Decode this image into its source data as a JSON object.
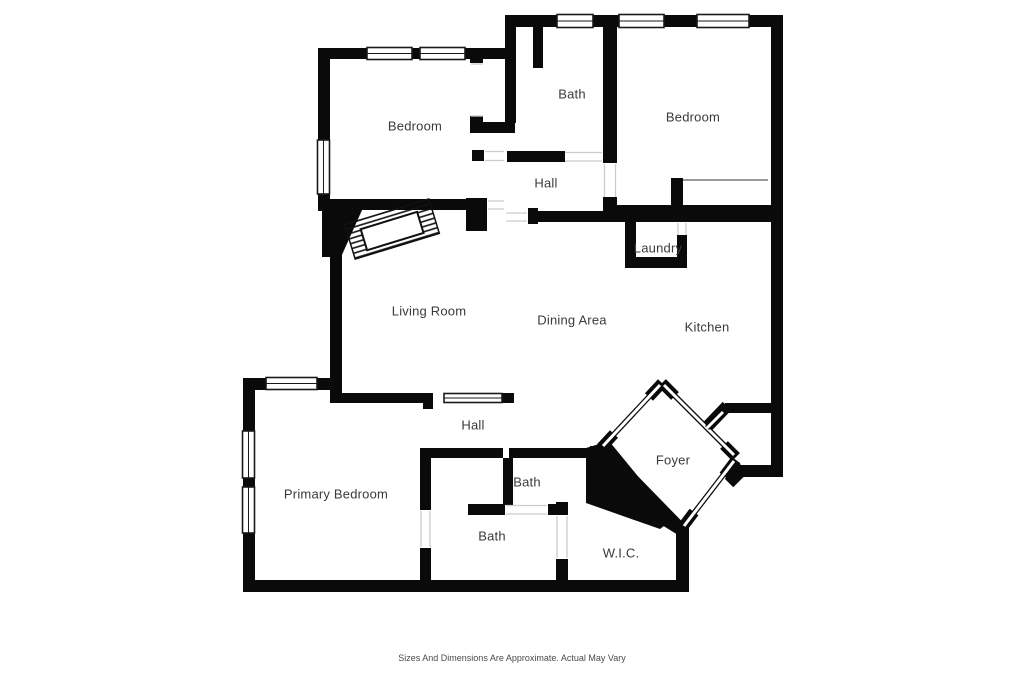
{
  "page": {
    "background": "#ffffff"
  },
  "plan": {
    "wall_color": "#0a0a0a",
    "label_color": "#3a3a3a",
    "rooms": [
      {
        "id": "bedroom-top-left",
        "label": "Bedroom",
        "x": 415,
        "y": 126
      },
      {
        "id": "bath-top",
        "label": "Bath",
        "x": 572,
        "y": 94
      },
      {
        "id": "bedroom-top-right",
        "label": "Bedroom",
        "x": 693,
        "y": 117
      },
      {
        "id": "hall-upper",
        "label": "Hall",
        "x": 546,
        "y": 183
      },
      {
        "id": "laundry",
        "label": "Laundry",
        "x": 658,
        "y": 248
      },
      {
        "id": "living-room",
        "label": "Living Room",
        "x": 429,
        "y": 311
      },
      {
        "id": "dining-area",
        "label": "Dining Area",
        "x": 572,
        "y": 320
      },
      {
        "id": "kitchen",
        "label": "Kitchen",
        "x": 707,
        "y": 327
      },
      {
        "id": "hall-lower",
        "label": "Hall",
        "x": 473,
        "y": 425
      },
      {
        "id": "primary-bedroom",
        "label": "Primary Bedroom",
        "x": 336,
        "y": 494
      },
      {
        "id": "bath-small",
        "label": "Bath",
        "x": 527,
        "y": 482
      },
      {
        "id": "bath-primary",
        "label": "Bath",
        "x": 492,
        "y": 536
      },
      {
        "id": "foyer",
        "label": "Foyer",
        "x": 673,
        "y": 460
      },
      {
        "id": "wic",
        "label": "W.I.C.",
        "x": 621,
        "y": 553
      }
    ],
    "footer": {
      "disclaimer": "Sizes And Dimensions Are Approximate. Actual May Vary"
    }
  }
}
